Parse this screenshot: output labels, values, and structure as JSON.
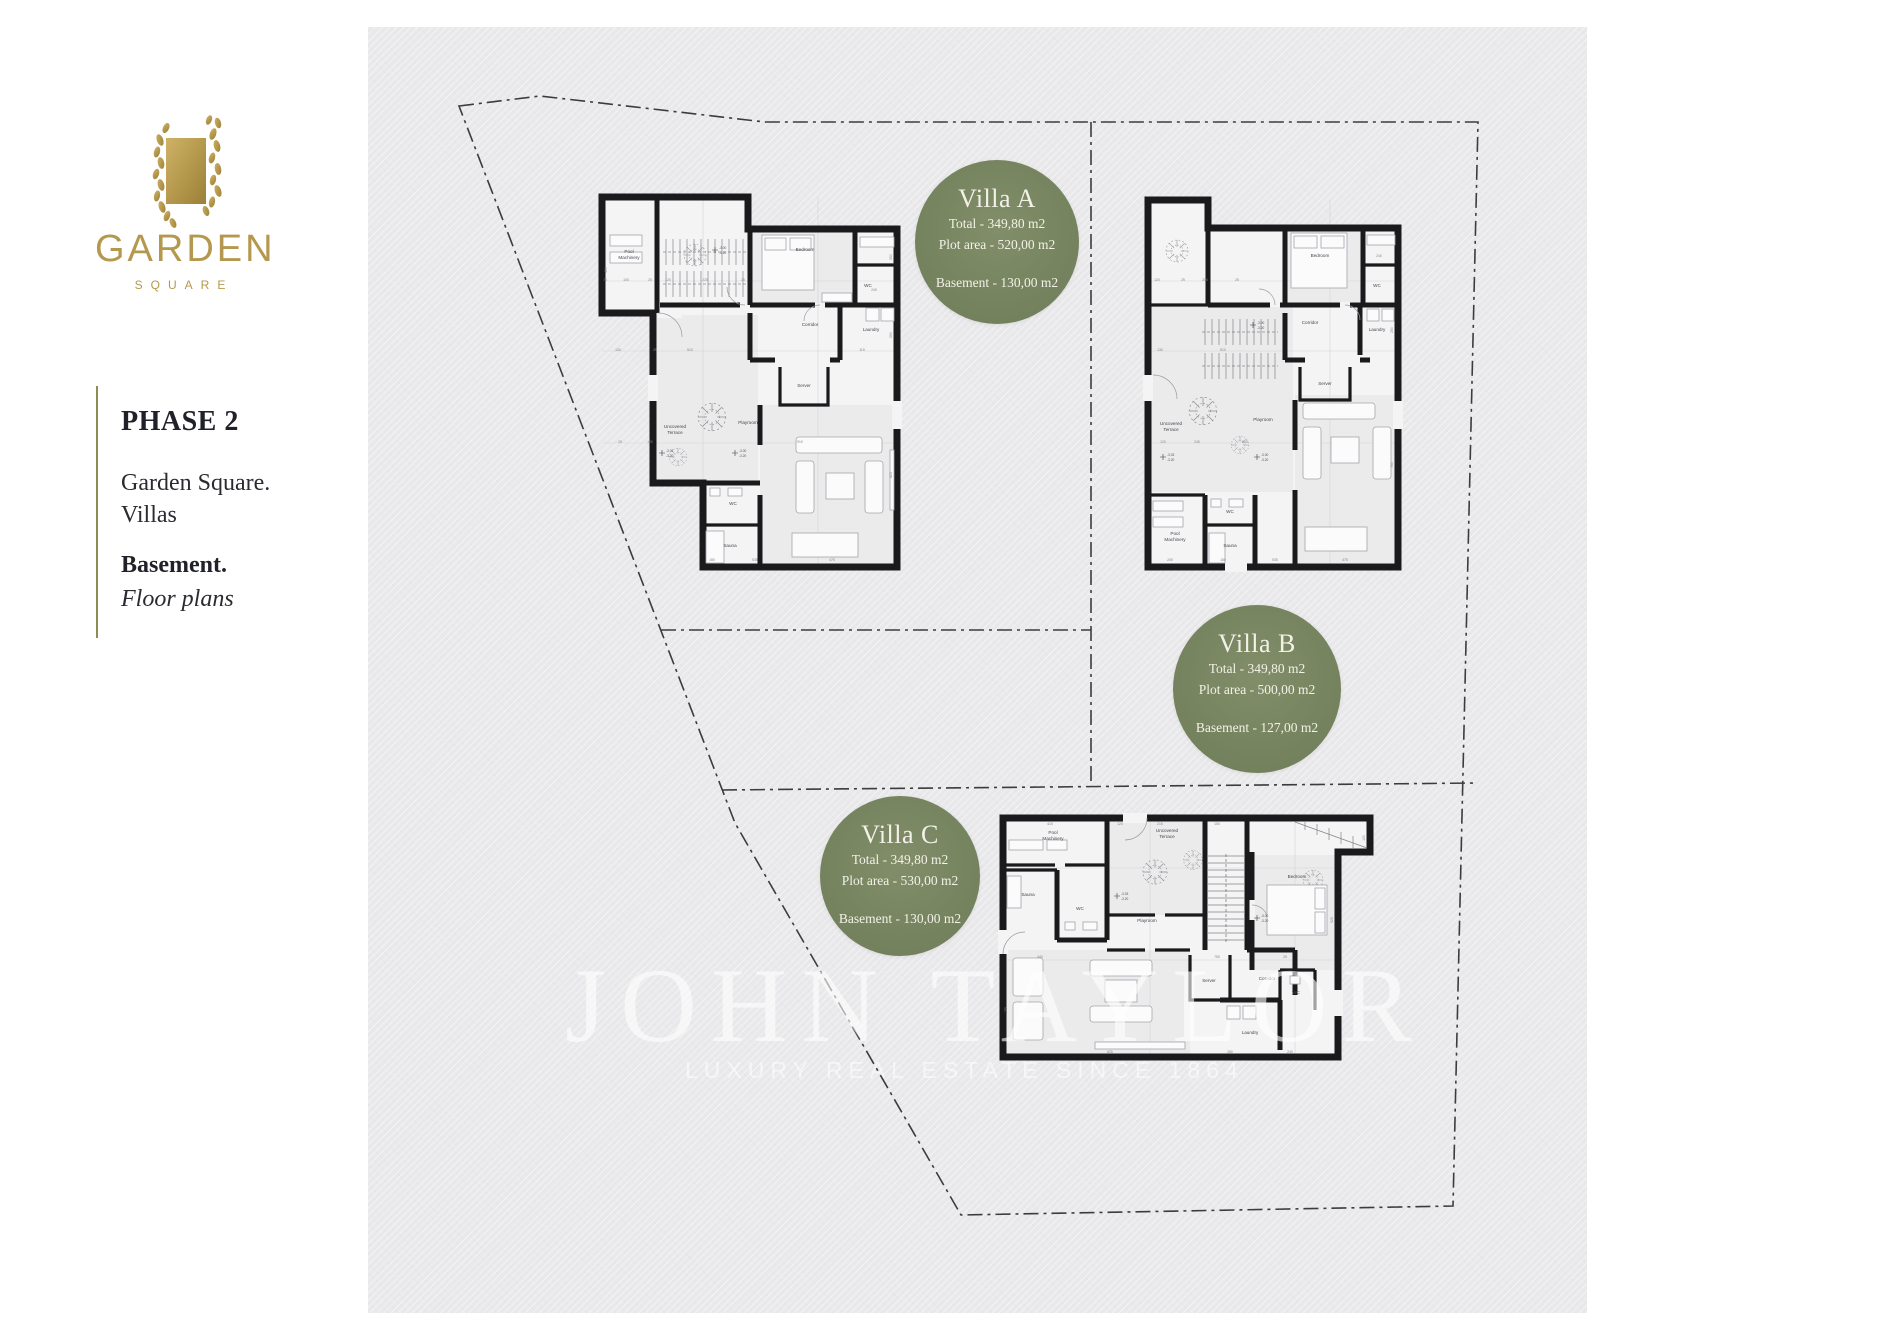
{
  "brand": {
    "name": "GARDEN",
    "sub": "SQUARE"
  },
  "sidebar": {
    "phase": "PHASE 2",
    "project": "Garden Square.",
    "project2": "Villas",
    "level": "Basement.",
    "level_sub": "Floor plans"
  },
  "badges": [
    {
      "title": "Villa A",
      "total": "Total - 349,80 m2",
      "plot": "Plot area - 520,00 m2",
      "basement": "Basement - 130,00 m2"
    },
    {
      "title": "Villa B",
      "total": "Total - 349,80 m2",
      "plot": "Plot area - 500,00 m2",
      "basement": "Basement - 127,00 m2"
    },
    {
      "title": "Villa C",
      "total": "Total - 349,80 m2",
      "plot": "Plot area - 530,00 m2",
      "basement": "Basement - 130,00 m2"
    }
  ],
  "watermark": {
    "line1": "JOHN TAYLOR",
    "line2": "LUXURY REAL ESTATE SINCE 1864"
  },
  "markers": {
    "m1a": "-3.00",
    "m1b": "-3.20",
    "m2a": "-3.03",
    "m2b": "-3.20"
  },
  "colors": {
    "badge_green": "#778460",
    "brand_gold": "#b4984d",
    "panel_gray": "#e9e9eb"
  },
  "plans": {
    "villaA": {
      "rooms": {
        "pool1": "Pool",
        "pool2": "Machinery",
        "bedroom": "Bedroom",
        "wc": "WC",
        "corridor": "Corridor",
        "laundry": "Laundry",
        "server": "Server",
        "terrace1": "Uncovered",
        "terrace2": "Terrace",
        "playroom": "Playroom",
        "wc2": "WC",
        "sauna": "Sauna"
      },
      "dims": [
        "75",
        "100",
        "25",
        "120",
        "220",
        "25",
        "130",
        "510",
        "115",
        "25",
        "120",
        "910",
        "180",
        "535",
        "475",
        "350",
        "290",
        "825",
        "240",
        "400"
      ]
    },
    "villaB": {
      "rooms": {
        "pool1": "Pool",
        "pool2": "Machinery",
        "bedroom": "Bedroom",
        "wc": "WC",
        "corridor": "Corridor",
        "laundry": "Laundry",
        "server": "Server",
        "terrace1": "Uncovered",
        "terrace2": "Terrace",
        "playroom": "Playroom",
        "wc2": "WC",
        "sauna": "Sauna"
      },
      "dims": [
        "120",
        "25",
        "200",
        "25",
        "130",
        "510",
        "240",
        "120",
        "245",
        "640",
        "290",
        "765",
        "205",
        "180",
        "535",
        "475"
      ]
    },
    "villaC": {
      "rooms": {
        "pool1": "Pool",
        "pool2": "Machinery",
        "bedroom": "Bedroom",
        "wc": "WC",
        "corridor": "Corridor",
        "laundry": "Laundry",
        "server": "Server",
        "terrace1": "Uncovered",
        "terrace2": "Terrace",
        "playroom": "Playroom",
        "wc2": "WC",
        "sauna": "Sauna"
      },
      "dims": [
        "415",
        "120",
        "215",
        "150",
        "440",
        "750",
        "25",
        "825",
        "280",
        "240",
        "925",
        "120",
        "175"
      ]
    }
  }
}
